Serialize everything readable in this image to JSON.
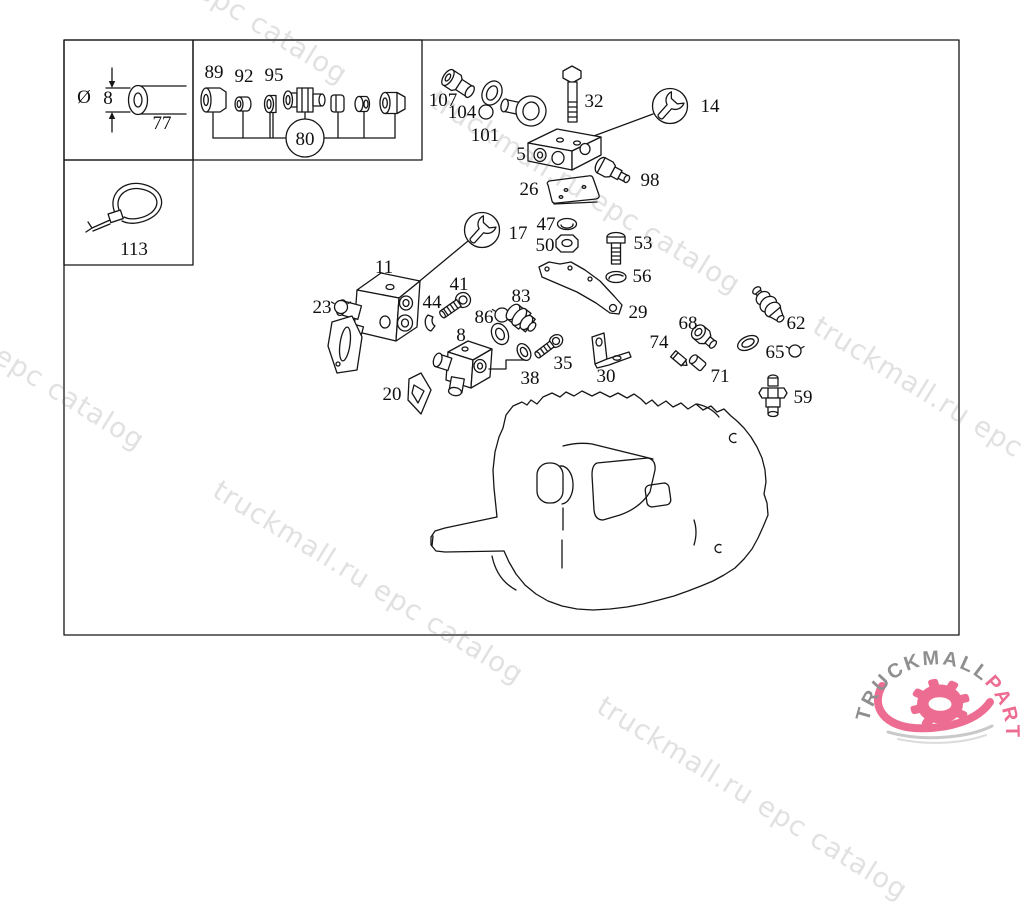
{
  "watermark": {
    "text": "truckmall.ru epc catalog",
    "color": "#e1e1e1"
  },
  "logo": {
    "truckmall": "TRUCKMALL",
    "parts": "PARTS",
    "gray": "#8f8f8f",
    "pink": "#ed6d92"
  },
  "diagram": {
    "type": "exploded-parts-diagram",
    "subject": "gearbox valve and sensor group",
    "line_color": "#161616"
  },
  "callouts": [
    {
      "id": "dia",
      "label": "Ø",
      "x": 84,
      "y": 103
    },
    {
      "id": "dim8",
      "label": "8",
      "x": 108,
      "y": 104
    },
    {
      "id": "77",
      "label": "77",
      "x": 162,
      "y": 129
    },
    {
      "id": "113",
      "label": "113",
      "x": 134,
      "y": 255
    },
    {
      "id": "89",
      "label": "89",
      "x": 214,
      "y": 78
    },
    {
      "id": "92",
      "label": "92",
      "x": 244,
      "y": 82
    },
    {
      "id": "95",
      "label": "95",
      "x": 274,
      "y": 81
    },
    {
      "id": "80",
      "label": "80",
      "x": 305,
      "y": 145
    },
    {
      "id": "107",
      "label": "107",
      "x": 443,
      "y": 106
    },
    {
      "id": "104",
      "label": "104",
      "x": 462,
      "y": 118
    },
    {
      "id": "101",
      "label": "101",
      "x": 485,
      "y": 141
    },
    {
      "id": "5",
      "label": "5",
      "x": 521,
      "y": 160
    },
    {
      "id": "32",
      "label": "32",
      "x": 594,
      "y": 107
    },
    {
      "id": "14",
      "label": "14",
      "x": 710,
      "y": 112
    },
    {
      "id": "98",
      "label": "98",
      "x": 650,
      "y": 186
    },
    {
      "id": "26",
      "label": "26",
      "x": 529,
      "y": 195
    },
    {
      "id": "17",
      "label": "17",
      "x": 518,
      "y": 239
    },
    {
      "id": "47",
      "label": "47",
      "x": 546,
      "y": 230
    },
    {
      "id": "50",
      "label": "50",
      "x": 545,
      "y": 251
    },
    {
      "id": "53",
      "label": "53",
      "x": 643,
      "y": 249
    },
    {
      "id": "56",
      "label": "56",
      "x": 642,
      "y": 282
    },
    {
      "id": "11",
      "label": "11",
      "x": 384,
      "y": 273
    },
    {
      "id": "23",
      "label": "23",
      "x": 322,
      "y": 313
    },
    {
      "id": "44",
      "label": "44",
      "x": 432,
      "y": 308
    },
    {
      "id": "41",
      "label": "41",
      "x": 459,
      "y": 290
    },
    {
      "id": "86",
      "label": "86",
      "x": 484,
      "y": 323
    },
    {
      "id": "8",
      "label": "8",
      "x": 461,
      "y": 341
    },
    {
      "id": "83",
      "label": "83",
      "x": 521,
      "y": 302
    },
    {
      "id": "29",
      "label": "29",
      "x": 638,
      "y": 318
    },
    {
      "id": "68",
      "label": "68",
      "x": 688,
      "y": 329
    },
    {
      "id": "74",
      "label": "74",
      "x": 659,
      "y": 348
    },
    {
      "id": "62",
      "label": "62",
      "x": 796,
      "y": 329
    },
    {
      "id": "65",
      "label": "65",
      "x": 775,
      "y": 358
    },
    {
      "id": "71",
      "label": "71",
      "x": 720,
      "y": 382
    },
    {
      "id": "30",
      "label": "30",
      "x": 606,
      "y": 382
    },
    {
      "id": "59",
      "label": "59",
      "x": 803,
      "y": 403
    },
    {
      "id": "20",
      "label": "20",
      "x": 392,
      "y": 400
    },
    {
      "id": "38",
      "label": "38",
      "x": 530,
      "y": 384
    },
    {
      "id": "35",
      "label": "35",
      "x": 563,
      "y": 369
    }
  ]
}
